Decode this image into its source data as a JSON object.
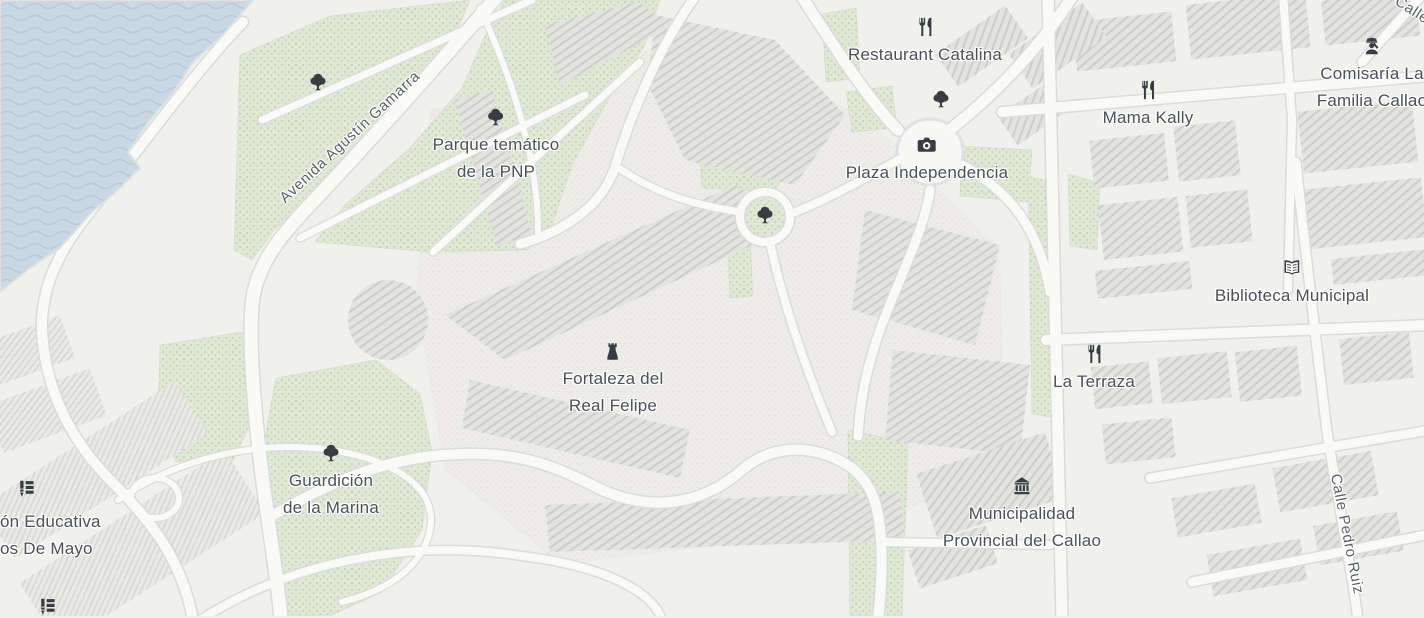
{
  "map": {
    "pois": {
      "restaurant_catalina": {
        "label": "Restaurant Catalina",
        "icon": "restaurant-icon"
      },
      "mama_kally": {
        "label": "Mama Kally",
        "icon": "restaurant-icon"
      },
      "comisaria": {
        "line1": "Comisaría La",
        "line2": "Familia Callao",
        "icon": "police-icon"
      },
      "plaza_independencia": {
        "label": "Plaza Independencia",
        "icon": "camera-icon"
      },
      "biblioteca_municipal": {
        "label": "Biblioteca Municipal",
        "icon": "book-icon"
      },
      "la_terraza": {
        "label": "La Terraza",
        "icon": "restaurant-icon"
      },
      "fortaleza": {
        "line1": "Fortaleza del",
        "line2": "Real Felipe",
        "icon": "castle-icon"
      },
      "parque_pnp": {
        "line1": "Parque temático",
        "line2": "de la PNP",
        "icon": "tree-icon"
      },
      "guardicion": {
        "line1": "Guardición",
        "line2": "de la Marina",
        "icon": "tree-icon"
      },
      "institucion_educativa": {
        "line1": "ón Educativa",
        "line2": "os De Mayo",
        "icon": "school-icon"
      },
      "municipalidad": {
        "line1": "Municipalidad",
        "line2": "Provincial del Callao",
        "icon": "bank-icon"
      }
    },
    "streets": {
      "avenida_agustin_gamarra": "Avenida Agustín Gamarra",
      "calle_pedro_ruiz": "Calle Pedro Ruiz",
      "calle_partial": "Calle"
    },
    "colors": {
      "water": "#c9d8e2",
      "wave_line": "#b5c9d6",
      "park": "#dfe7d5",
      "park_dot": "#b9c7ab",
      "land": "#f0f0ed",
      "building": "#e3e3e0",
      "building_hatch": "#cdcdc9",
      "road": "#f9faf8",
      "road_casing": "#d9dcda",
      "label_text": "#4b5055",
      "icon": "#383d42"
    }
  }
}
